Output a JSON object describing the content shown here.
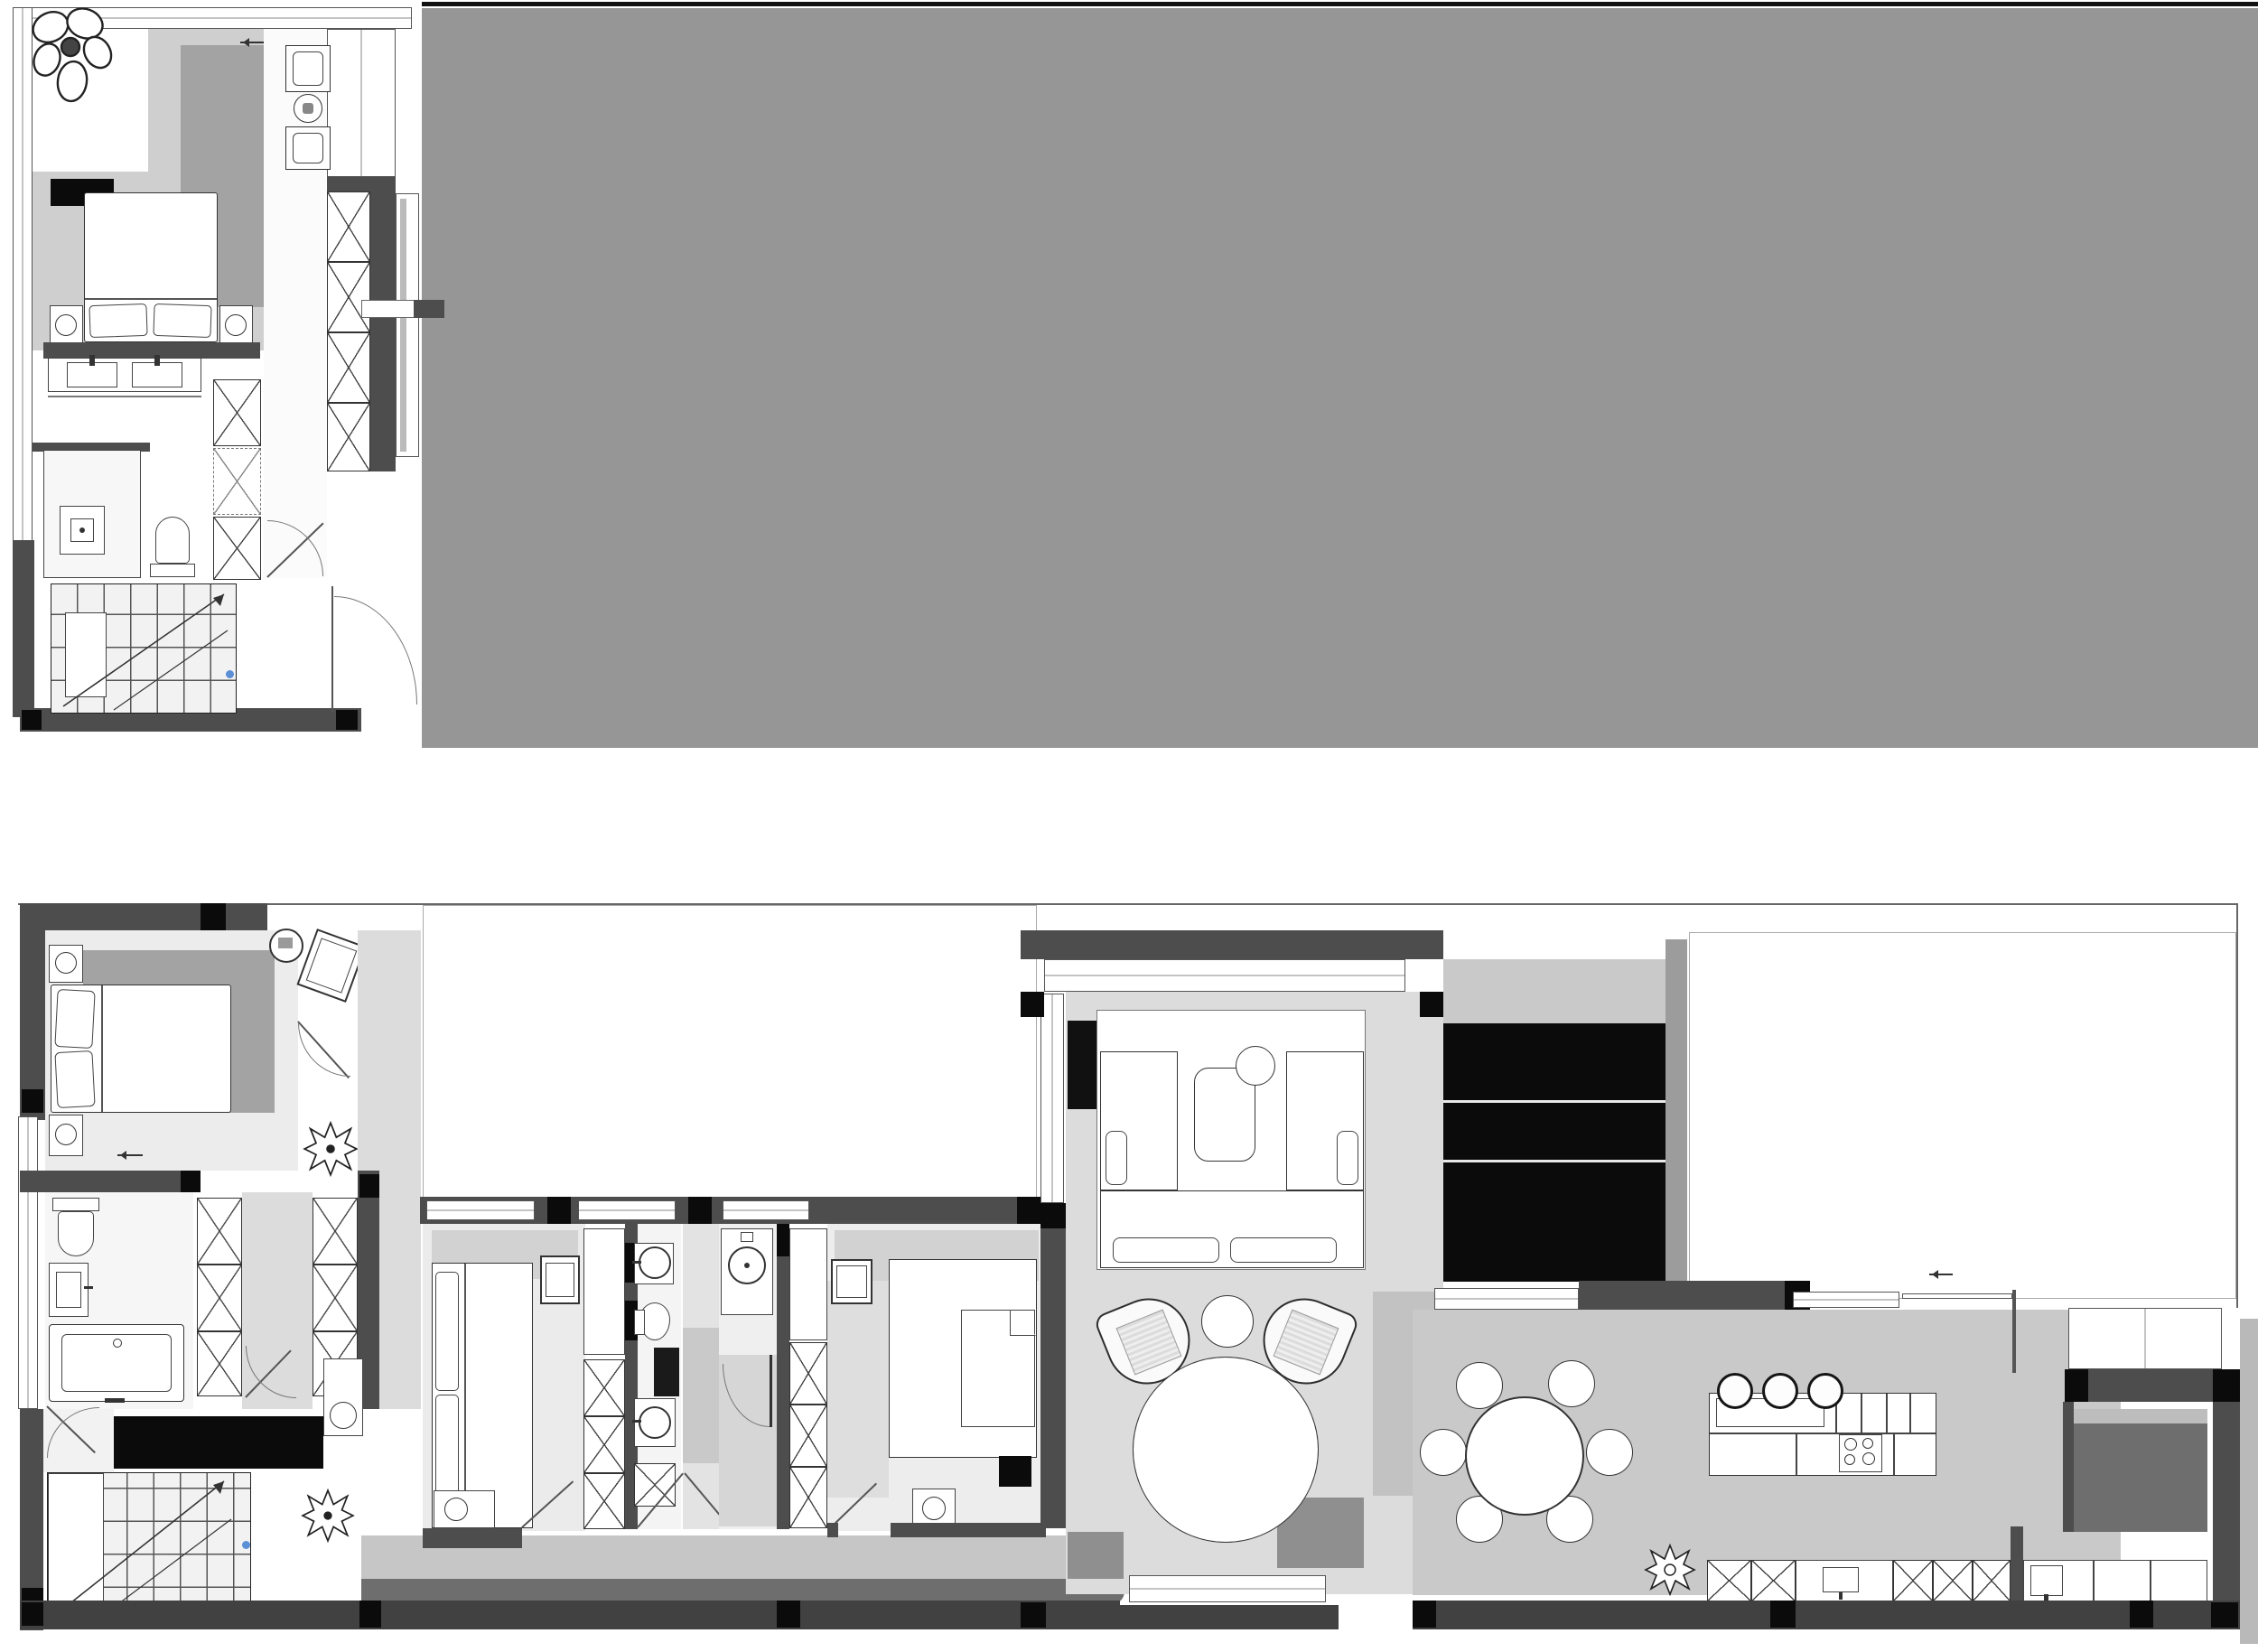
{
  "app": {
    "title": "Two-storey apartment CAD floor plan"
  },
  "palette": {
    "background": "#ffffff",
    "overlay_gray": "#969696",
    "wall_gray": "#4d4d4d",
    "wall_dark": "#414141",
    "column_black": "#0b0b0b",
    "line": "#333333",
    "floor_light": "#dcdcdc",
    "floor_mid": "#c6c6c6",
    "floor_shaded": "#a3a3a3",
    "deck_dark": "#6e6e6e",
    "terrace_outline": "#999999",
    "accent_blue": "#5b8fd6"
  },
  "icons": [
    "flower-plant-icon",
    "plant-icon",
    "arrow-left-icon",
    "stair-arrow-icon",
    "lamp-circle-icon",
    "sink-icon",
    "toilet-icon",
    "bathtub-icon",
    "shower-icon",
    "hob-icon",
    "tv-icon",
    "washer-icon"
  ],
  "plans": {
    "upper": {
      "label": "Upper floor plan",
      "rooms": {
        "bedroom": "Bedroom",
        "vanity": "Vanity / dressing",
        "bathroom": "Bathroom",
        "laundry": "Laundry niche",
        "wardrobe": "Wardrobe closets",
        "stairs": "Staircase",
        "bay": "Window bay"
      }
    },
    "lower": {
      "label": "Main floor plan",
      "rooms": {
        "bedroom1": "Bedroom 1",
        "bathroom1": "Bathroom 1",
        "stairs": "Staircase",
        "hall": "Hallway",
        "bedroom2": "Bedroom 2",
        "wc1": "WC / shower 1",
        "wc2": "WC / shower 2",
        "bedroom3": "Bedroom 3",
        "living": "Living room",
        "lounge": "Lounge seating",
        "dining": "Dining area",
        "kitchen": "Kitchen",
        "utility": "Utility / service room",
        "terrace_mid": "Open terrace (middle)",
        "terrace_right": "Open terrace (right)"
      }
    },
    "overlay": "Gray masked region"
  },
  "furniture": {
    "beds": 4,
    "sofas": 3,
    "armchairs": 2,
    "dining_chairs": 6,
    "bar_stools": 3,
    "round_tables": 4,
    "wardrobe_x_cells": 20,
    "plants": 4,
    "staircases": 2
  }
}
